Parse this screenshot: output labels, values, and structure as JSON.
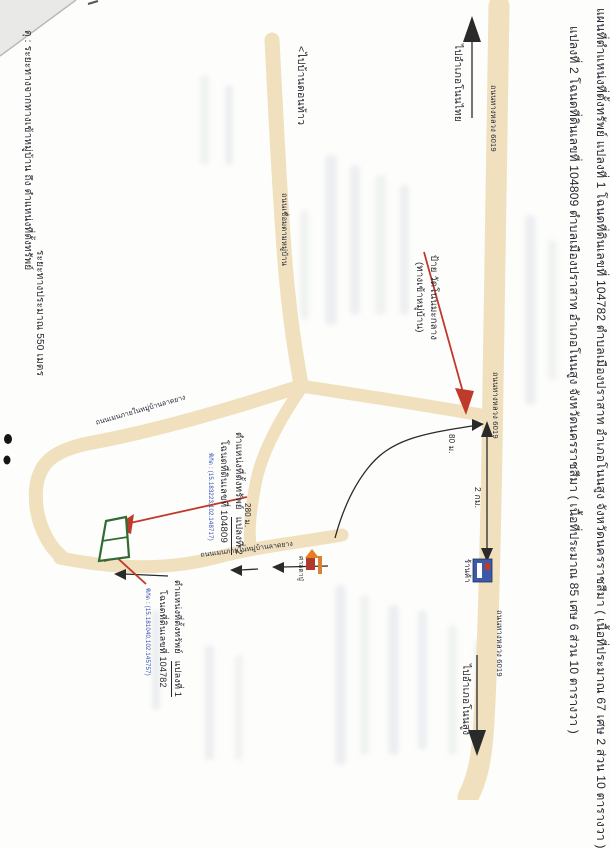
{
  "title": {
    "line1": "แผนที่ตำแหน่งที่ตั้งทรัพย์ แปลงที่ 1 โฉนดที่ดินเลขที่ 104782 ตำบลเมืองปราสาท อำเภอโนนสูง จังหวัดนครราชสีมา ( เนื้อที่ประมาณ 67 เศษ 2 ส่วน 10 ตารางวา )",
    "line2": "แปลงที่ 2 โฉนดที่ดินเลขที่ 104809 ตำบลเมืองปราสาท อำเภอโนนสูง จังหวัดนครราชสีมา ( เนื้อที่ประมาณ 85 เศษ 6 ส่วน 10 ตารางวา )"
  },
  "note": {
    "line1": "ตุ : ระยะทางจากทางเข้าหมู่บ้าน ถึง ตำแหน่งที่ตั้งทรัพย์",
    "line2": "ระยะทางประมาณ 550 เมตร"
  },
  "roads": {
    "highway_label": "ถนนทางหลวง 6019",
    "connector_label": "ถนนเชื่อมตามหมู่บ้าน",
    "village_main_label": "ถนนเมนภายในหมู่บ้านลาดยาง"
  },
  "directions": {
    "north": "ไปอำเภอโนนไทย",
    "south": "ไปอำเภอโนนสูง",
    "west": "<ไปบ้านดอนท้าว"
  },
  "junction": {
    "line1": "ป้าย วัดโนนมะกลาง",
    "line2": "(ทางเข้าหมู่บ้าน)"
  },
  "distances": {
    "highway": "2 กม.",
    "entrance": "80 ม.",
    "village": "280 ม."
  },
  "pois": {
    "shop": "ร้านค้า",
    "shrine": "ศาลตาปู่"
  },
  "parcel2": {
    "label": "ตำแหน่งที่ตั้งทรัพย์",
    "plot": "แปลงที่ 2",
    "deed": "โฉนดที่ดินเลขที่ 104809",
    "coords": "พิกัด : (15.183223,102.148717)"
  },
  "parcel1": {
    "label": "ตำแหน่งที่ตั้งทรัพย์",
    "plot": "แปลงที่ 1",
    "deed": "โฉนดที่ดินเลขที่ 104782",
    "coords": "พิกัด : (15.181040,102.145757)"
  },
  "colors": {
    "road": "#f0e0bd",
    "red_arrow": "#bf3a2b",
    "parcel_green": "#2f6d33",
    "blue_pen": "#2d4bb5",
    "ink": "#26262e"
  }
}
